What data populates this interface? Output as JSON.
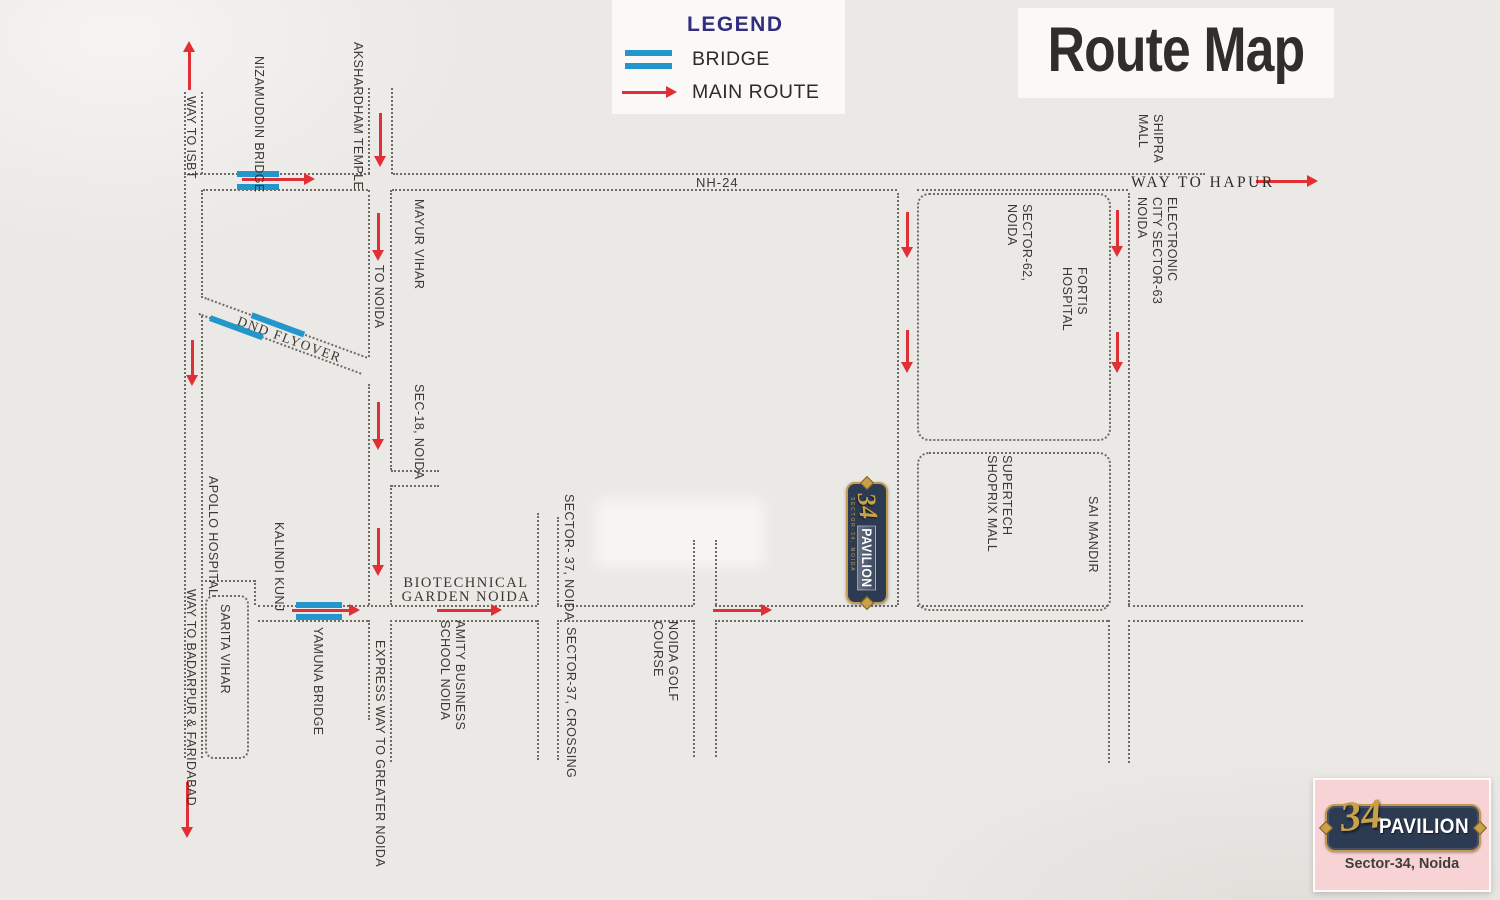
{
  "title": "Route Map",
  "legend": {
    "heading": "LEGEND",
    "bridge_label": "BRIDGE",
    "main_route_label": "MAIN ROUTE"
  },
  "colors": {
    "background": "#ebe9e6",
    "road_line": "#6e6a64",
    "bridge_blue": "#2396cc",
    "route_red": "#e02f35",
    "legend_heading_blue": "#322d7e",
    "plaque_navy": "#2c3a52",
    "gold": "#c49a4e",
    "logo_pink": "#f8d3d5"
  },
  "labels": {
    "way_to_isbt": "WAY TO ISBT",
    "nizamuddin_bridge": "NIZAMUDDIN BRIDGE",
    "akshardham_temple": "AKSHARDHAM TEMPLE",
    "mayur_vihar": "MAYUR VIHAR",
    "to_noida": "TO NOIDA",
    "nh_24": "NH-24",
    "way_to_hapur": "WAY TO HAPUR",
    "shipra_mall": "SHIPRA\nMALL",
    "electronic_city": "ELECTRONIC\nCITY SECTOR-63\nNOIDA",
    "sector_62": "SECTOR-62,\nNOIDA",
    "fortis_hospital": "FORTIS\nHOSPITAL",
    "dnd_flyover": "DND FLYOVER",
    "sec_18": "SEC-18, NOIDA",
    "apollo_hospital": "APOLLO HOSPITAL",
    "kalindi_kunj": "KALINDI KUNJ",
    "sarita_vihar": "SARITA VIHAR",
    "way_to_badarpur": "WAY TO BADARPUR & FARIDABAD",
    "yamuna_bridge": "YAMUNA BRIDGE",
    "express_way": "EXPRESS WAY TO GREATER NOIDA",
    "biotechnical_garden": "BIOTECHNICAL\nGARDEN NOIDA",
    "amity_business": "AMITY BUSINESS\nSCHOOL NOIDA",
    "sector_37_noida": "SECTOR- 37, NOIDA",
    "sector_37_crossing": "SECTOR-37, CROSSING",
    "noida_golf_course": "NOIDA GOLF\nCOURSE",
    "supertech_shoprix": "SUPERTECH\nSHOPRIX MALL",
    "sai_mandir": "SAI MANDIR"
  },
  "marker": {
    "number": "34",
    "name": "PAVILION",
    "subtitle": "SECTOR-34, NOIDA"
  },
  "logo": {
    "number": "34",
    "name": "PAVILION",
    "address": "Sector-34, Noida"
  }
}
